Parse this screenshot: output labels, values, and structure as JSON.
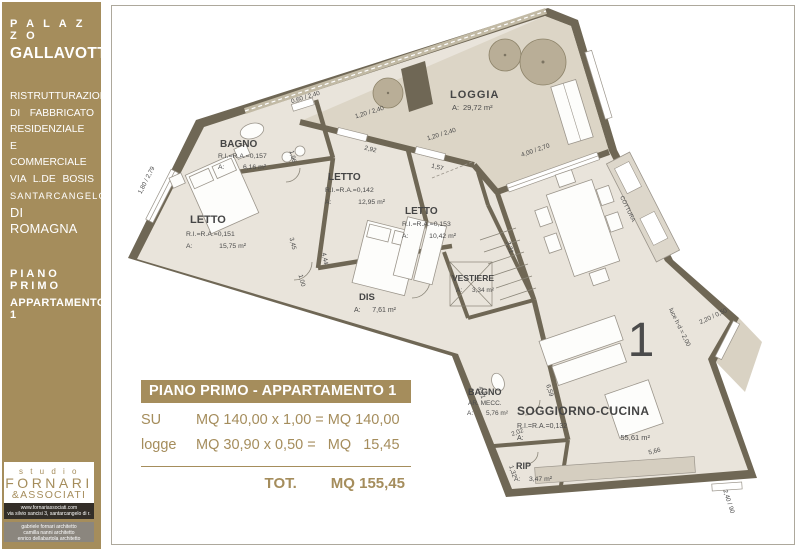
{
  "sidebar": {
    "title_small": "P A L A Z Z O",
    "title": "GALLAVOTTI",
    "description": [
      "RISTRUTTURAZIONE",
      "DI FABBRICATO",
      "RESIDENZIALE E",
      "COMMERCIALE",
      "VIA L.DE BOSIS",
      "SANTARCANGELO",
      "DI ROMAGNA"
    ],
    "floor_label": "PIANO PRIMO",
    "apartment_label": "APPARTAMENTO 1",
    "accent_color": "#A58D5C",
    "logo": {
      "studio": "s t u d i o",
      "name": "FORNARI",
      "name2": "&ASSOCIATI",
      "website": "www.fornariassociati.com",
      "address": "via silvio sancisi 3, santarcangelo di r.",
      "architects": [
        "gabriele fornari architetto",
        "camilla nanni architetto",
        "enrico dellabartola architetto"
      ]
    }
  },
  "summary_table": {
    "header": "PIANO PRIMO - APPARTAMENTO 1",
    "rows": [
      {
        "label": "SU",
        "formula": "MQ 140,00 x 1,00 = MQ 140,00"
      },
      {
        "label": "logge",
        "formula": "MQ 30,90 x 0,50 =   MQ   15,45"
      }
    ],
    "total_label": "TOT.",
    "total_value": "MQ 155,45"
  },
  "plan": {
    "apartment_number": "1",
    "rooms": {
      "loggia": {
        "name": "LOGGIA",
        "area_label": "A:",
        "area_value": "29,72 m²"
      },
      "bagno1": {
        "name": "BAGNO",
        "ratio": "R.I.=R.A.=0,157",
        "area_label": "A:",
        "area_value": "6,16 m²"
      },
      "letto1": {
        "name": "LETTO",
        "ratio": "R.I.=R.A.=0,151",
        "area_label": "A:",
        "area_value": "15,75 m²"
      },
      "letto2": {
        "name": "LETTO",
        "ratio": "R.I.=R.A.=0,142",
        "area_label": "A:",
        "area_value": "12,95 m²"
      },
      "letto3": {
        "name": "LETTO",
        "ratio": "R.I.=R.A.=0,153",
        "area_label": "A:",
        "area_value": "10,42 m²"
      },
      "vestiere": {
        "name": "VESTIERE",
        "area_label": "A:",
        "area_value": "3,34 m²"
      },
      "dis": {
        "name": "DIS",
        "area_label": "A:",
        "area_value": "7,61 m²"
      },
      "bagno2": {
        "name": "BAGNO",
        "sub": "AR. MECC.",
        "area_label": "A:",
        "area_value": "5,76 m²"
      },
      "soggiorno": {
        "name": "SOGGIORNO-CUCINA",
        "ratio": "R.I.=R.A.=0,132",
        "area_label": "A:",
        "area_value": "55,61 m²"
      },
      "rip": {
        "name": "RIP",
        "area_label": "A:",
        "area_value": "3,47 m²"
      },
      "cottura": {
        "name": "COTTURA"
      }
    },
    "dimensions": [
      "1,80 / 2,79",
      "0,60 / 2,40",
      "1,20 / 2,40",
      "1,20 / 2,40",
      "2,92",
      "1,57",
      "1,96",
      "4,44",
      "3,45",
      "1,00",
      "4,00 / 2,70",
      "3,31",
      "6,59",
      "2,02",
      "1,32",
      "4,61",
      "5,66",
      "2,20 / 0,50",
      "luce h-d = 2,00",
      "2,40 / 90"
    ]
  }
}
